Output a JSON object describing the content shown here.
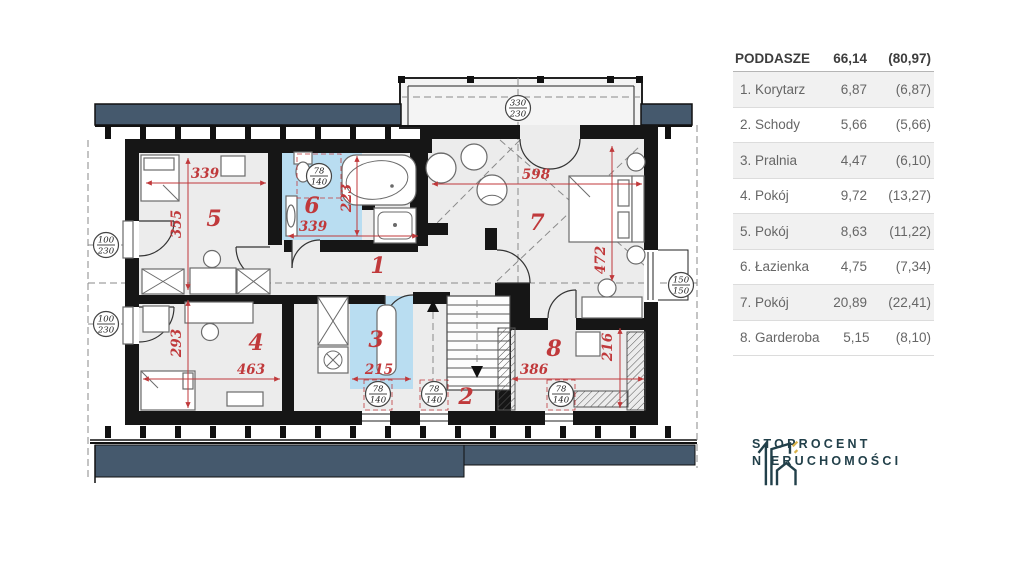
{
  "palette": {
    "roof_navy": "#45596d",
    "room_blue": "#b9ddf1",
    "dim_red": "#c0393b",
    "wall_black": "#161616",
    "logo_teal": "#22404a",
    "logo_gold": "#d9b24a"
  },
  "plan": {
    "room_numbers": {
      "r1": "1",
      "r2": "2",
      "r3": "3",
      "r4": "4",
      "r5": "5",
      "r6": "6",
      "r7": "7",
      "r8": "8"
    },
    "dimensions": {
      "r5_w": "339",
      "r5_h": "355",
      "r6_w": "339",
      "r6_h": "223",
      "r7_w": "598",
      "r7_h": "472",
      "r4_w": "463",
      "r4_h": "293",
      "r3_w": "215",
      "r8_w": "386",
      "r8_h": "216"
    },
    "markers": {
      "left_upper": {
        "top": "100",
        "bottom": "230"
      },
      "left_lower": {
        "top": "100",
        "bottom": "230"
      },
      "balcony": {
        "top": "330",
        "bottom": "230"
      },
      "right": {
        "top": "150",
        "bottom": "150"
      },
      "skylight_bath": {
        "top": "78",
        "bottom": "140"
      },
      "skylight_r3": {
        "top": "78",
        "bottom": "140"
      },
      "skylight_r2": {
        "top": "78",
        "bottom": "140"
      },
      "skylight_r8": {
        "top": "78",
        "bottom": "140"
      }
    }
  },
  "legend": {
    "header": {
      "name": "PODDASZE",
      "area": "66,14",
      "gross": "(80,97)"
    },
    "rows": [
      {
        "name": "1. Korytarz",
        "area": "6,87",
        "gross": "(6,87)"
      },
      {
        "name": "2. Schody",
        "area": "5,66",
        "gross": "(5,66)"
      },
      {
        "name": "3. Pralnia",
        "area": "4,47",
        "gross": "(6,10)"
      },
      {
        "name": "4. Pokój",
        "area": "9,72",
        "gross": "(13,27)"
      },
      {
        "name": "5. Pokój",
        "area": "8,63",
        "gross": "(11,22)"
      },
      {
        "name": "6. Łazienka",
        "area": "4,75",
        "gross": "(7,34)"
      },
      {
        "name": "7. Pokój",
        "area": "20,89",
        "gross": "(22,41)"
      },
      {
        "name": "8. Garderoba",
        "area": "5,15",
        "gross": "(8,10)"
      }
    ]
  },
  "logo": {
    "line1": "STOPROCENT",
    "line2": "NIERUCHOMOŚCI"
  }
}
